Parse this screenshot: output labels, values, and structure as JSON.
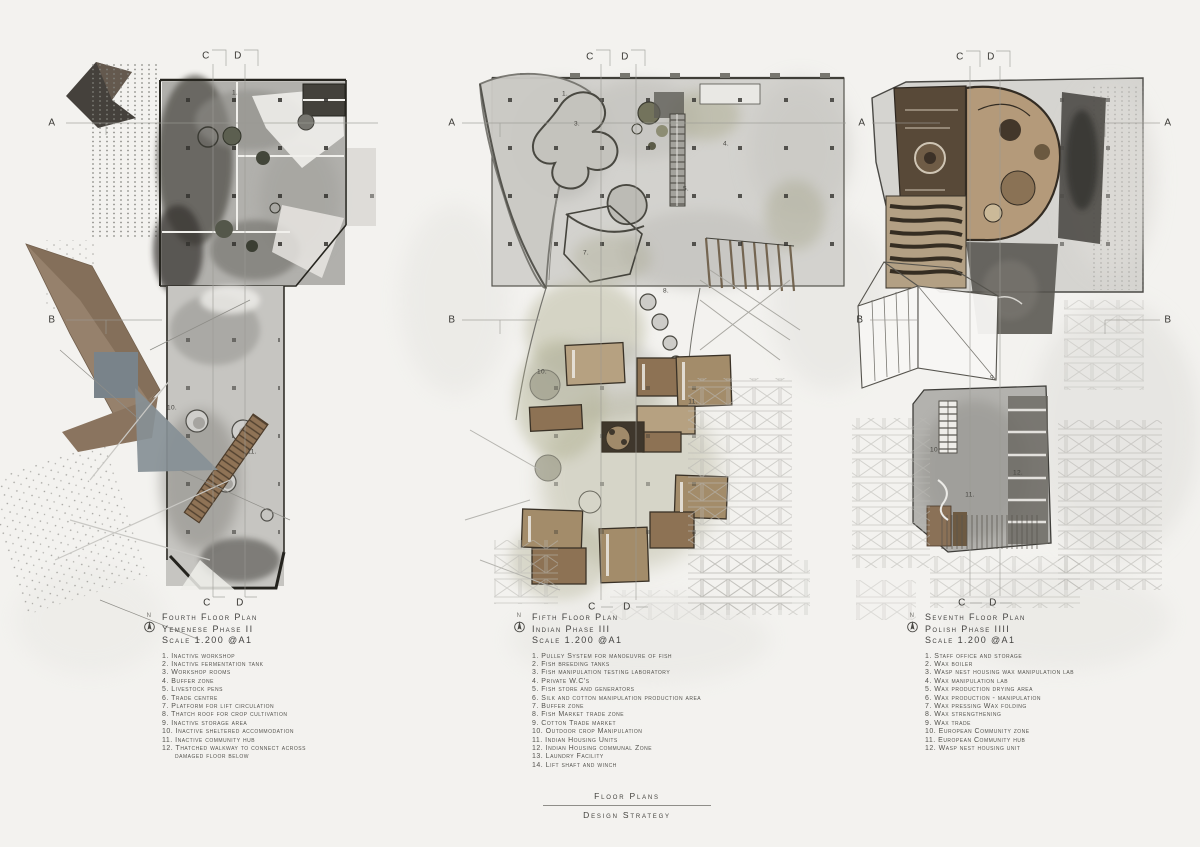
{
  "sheet": {
    "footer_title": "Floor Plans",
    "footer_subtitle": "Design Strategy"
  },
  "legends": [
    {
      "north": "N",
      "title": "Fourth Floor Plan",
      "phase": "Yemenese Phase II",
      "scale": "Scale 1.200 @A1",
      "items": [
        "1. Inactive workshop",
        "2. Inactive fermentation tank",
        "3. Workshop rooms",
        "4. Buffer zone",
        "5. Livestock pens",
        "6. Trade centre",
        "7. Platform for lift circulation",
        "8. Thatch roof for crop cultivation",
        "9. Inactive storage area",
        "10. Inactive sheltered accommodation",
        "11. Inactive community hub",
        "12. Thatched walkway to connect across\ndamaged floor below"
      ]
    },
    {
      "north": "N",
      "title": "Fifth Floor Plan",
      "phase": "Indian Phase III",
      "scale": "Scale 1.200 @A1",
      "items": [
        "1. Pulley System for manoeuvre of fish",
        "2. Fish breeding tanks",
        "3. Fish manipulation testing laboratory",
        "4. Private W.C's",
        "5. Fish store and generators",
        "6. Silk and cotton manipulation production area",
        "7. Buffer zone",
        "8. Fish Market trade zone",
        "9. Cotton Trade market",
        "10. Outdoor crop Manipulation",
        "11. Indian Housing Units",
        "12. Indian Housing communal Zone",
        "13. Laundry Facility",
        "14. Lift shaft and winch"
      ]
    },
    {
      "north": "N",
      "title": "Seventh Floor Plan",
      "phase": "Polish Phase IIII",
      "scale": "Scale 1.200 @A1",
      "items": [
        "1. Staff office and storage",
        "2. Wax boiler",
        "3. Wasp nest housing wax manipulation lab",
        "4. Wax manipulation lab",
        "5. Wax production drying area",
        "6. Wax production - manipulation",
        "7. Wax pressing Wax folding",
        "8. Wax strengthening",
        "9. Wax trade",
        "10. European Community zone",
        "11. European Community hub",
        "12. Wasp nest housing unit"
      ]
    }
  ],
  "section_markers": [
    {
      "label": "A",
      "x": 52,
      "y": 123
    },
    {
      "label": "A",
      "x": 452,
      "y": 123
    },
    {
      "label": "A",
      "x": 862,
      "y": 123
    },
    {
      "label": "A",
      "x": 1168,
      "y": 123
    },
    {
      "label": "B",
      "x": 52,
      "y": 320
    },
    {
      "label": "B",
      "x": 452,
      "y": 320
    },
    {
      "label": "B",
      "x": 860,
      "y": 320
    },
    {
      "label": "B",
      "x": 1168,
      "y": 320
    },
    {
      "label": "C",
      "x": 206,
      "y": 56
    },
    {
      "label": "D",
      "x": 238,
      "y": 56
    },
    {
      "label": "C",
      "x": 590,
      "y": 57
    },
    {
      "label": "D",
      "x": 625,
      "y": 57
    },
    {
      "label": "C",
      "x": 960,
      "y": 57
    },
    {
      "label": "D",
      "x": 991,
      "y": 57
    },
    {
      "label": "C",
      "x": 207,
      "y": 603
    },
    {
      "label": "D",
      "x": 240,
      "y": 603
    },
    {
      "label": "C",
      "x": 592,
      "y": 607
    },
    {
      "label": "D",
      "x": 627,
      "y": 607
    },
    {
      "label": "C",
      "x": 962,
      "y": 603
    },
    {
      "label": "D",
      "x": 993,
      "y": 603
    }
  ],
  "plan_numbers": [
    {
      "label": "1.",
      "x": 235,
      "y": 93
    },
    {
      "label": "10.",
      "x": 172,
      "y": 408
    },
    {
      "label": "11.",
      "x": 252,
      "y": 452
    },
    {
      "label": "1.",
      "x": 565,
      "y": 94
    },
    {
      "label": "3.",
      "x": 577,
      "y": 124
    },
    {
      "label": "4.",
      "x": 726,
      "y": 144
    },
    {
      "label": "5.",
      "x": 686,
      "y": 189
    },
    {
      "label": "7.",
      "x": 586,
      "y": 253
    },
    {
      "label": "8.",
      "x": 666,
      "y": 291
    },
    {
      "label": "10.",
      "x": 542,
      "y": 372
    },
    {
      "label": "11.",
      "x": 693,
      "y": 402
    },
    {
      "label": "9.",
      "x": 993,
      "y": 378
    },
    {
      "label": "10.",
      "x": 935,
      "y": 450
    },
    {
      "label": "11.",
      "x": 970,
      "y": 495
    },
    {
      "label": "12.",
      "x": 1018,
      "y": 473
    }
  ],
  "colors": {
    "paper": "#f3f2ef",
    "ink": "#3e3d39",
    "brown_wing": "#96816c",
    "room_brown": "#8d7254",
    "room_tan": "#b6a181",
    "olive_wash": "#abaa8d",
    "blue_gray": "#818a90",
    "charcoal": "#4c4a46",
    "teardrop_tan": "#b49a7a"
  }
}
